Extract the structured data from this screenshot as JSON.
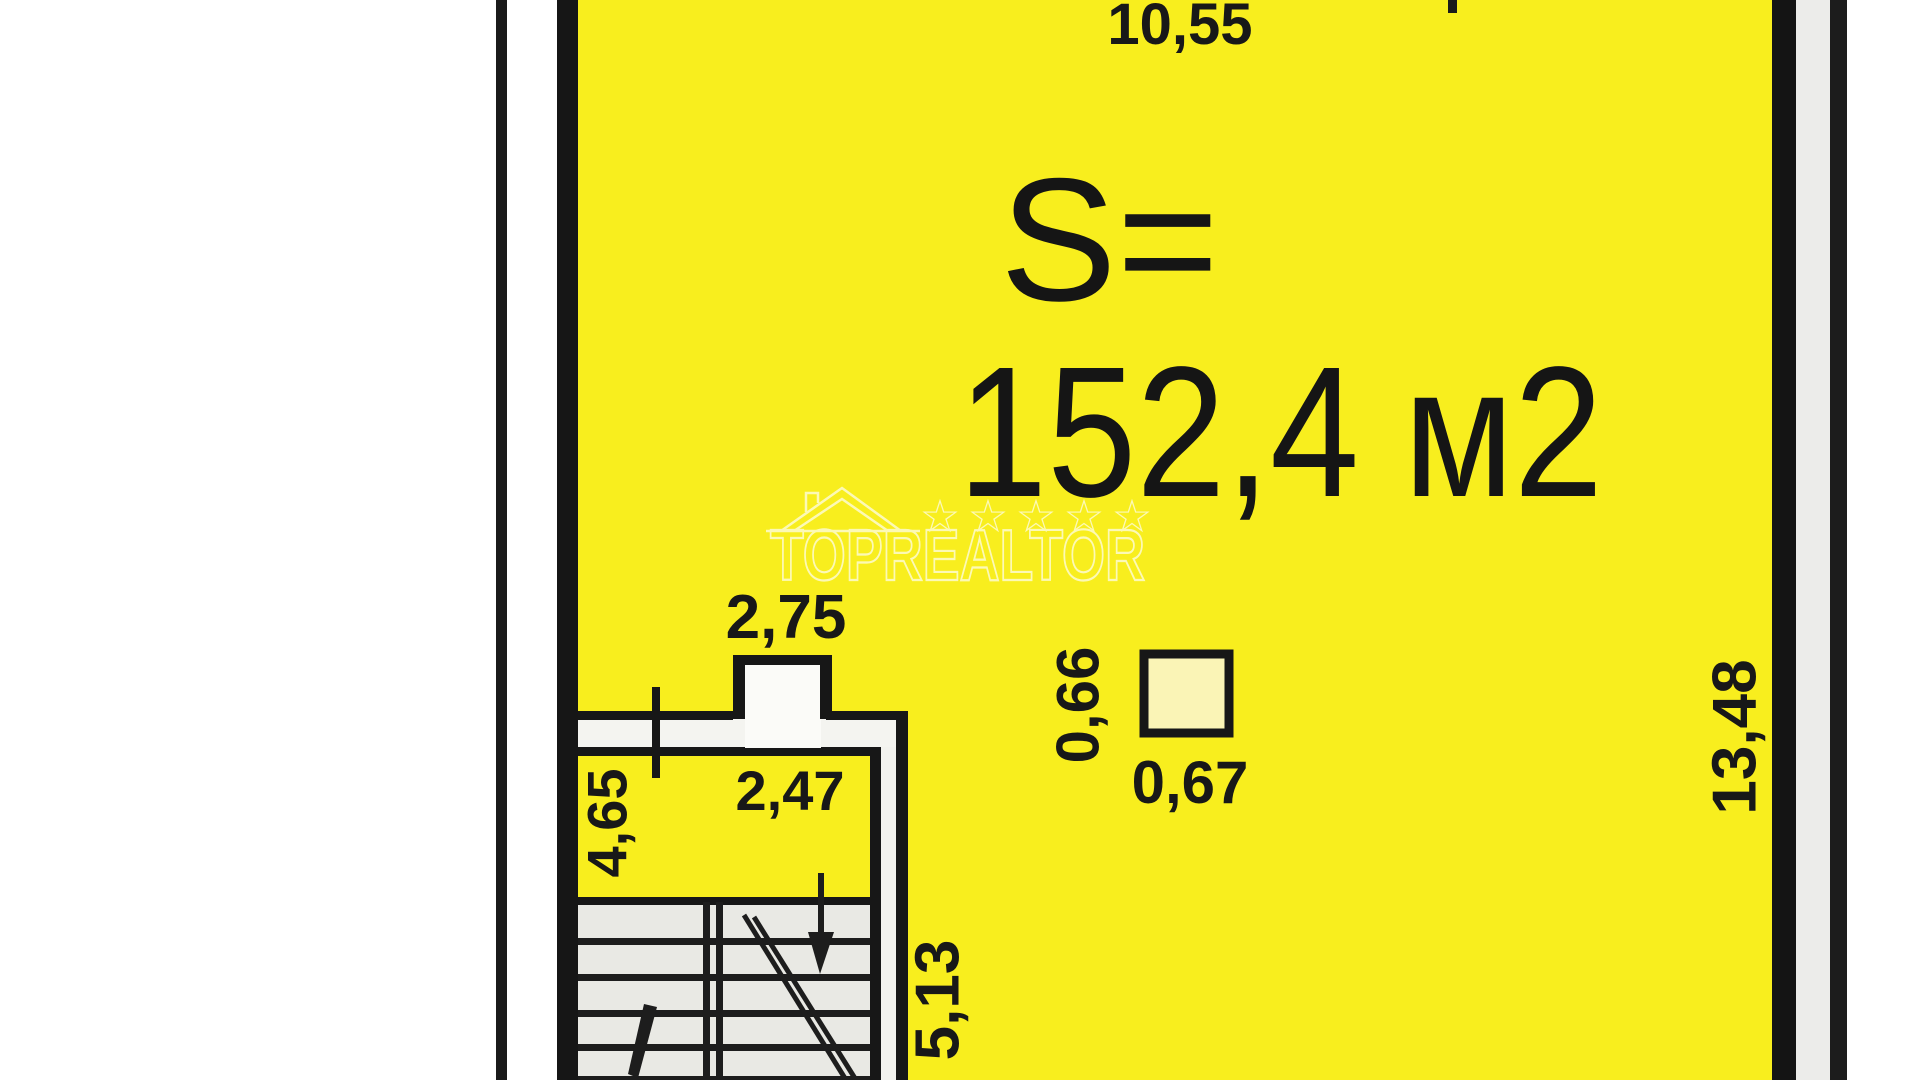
{
  "plan": {
    "area_prefix": "S=",
    "area_value": "152,4 м2",
    "dim_top_width": "10,55",
    "dim_shaft_width": "2,75",
    "dim_room_width": "2,47",
    "dim_room_depth": "4,65",
    "dim_column_height": "0,66",
    "dim_column_width": "0,67",
    "dim_right_height": "13,48",
    "dim_stair_depth": "5,13"
  },
  "watermark": {
    "brand": "TOPREALTOR",
    "star": "☆"
  },
  "colors": {
    "yellow": "#f8ee1e",
    "ink": "#181818",
    "corridor_white": "#f4f4f0",
    "stair_fill": "#e9e9e4"
  }
}
